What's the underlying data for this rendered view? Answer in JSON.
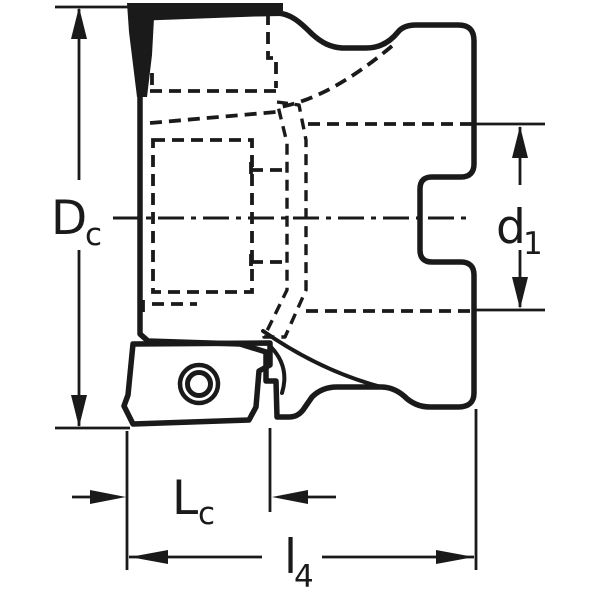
{
  "figure": {
    "type": "technical-drawing",
    "subject": "Indexable face milling cutter, side view with yellow insert and highlighted cutting edge",
    "colors": {
      "background": "#ffffff",
      "body_fill": "#d6dbdc",
      "insert_fill": "#f3cf71",
      "highlight": "#4cd9f0",
      "line": "#1a1a1a"
    },
    "dimensions": {
      "cutting_diameter": {
        "main": "D",
        "sub": "c"
      },
      "connection_diameter": {
        "main": "d",
        "sub": "1"
      },
      "cutting_edge_length": {
        "main": "L",
        "sub": "c"
      },
      "overall_length": {
        "main": "l",
        "sub": "4"
      }
    }
  }
}
